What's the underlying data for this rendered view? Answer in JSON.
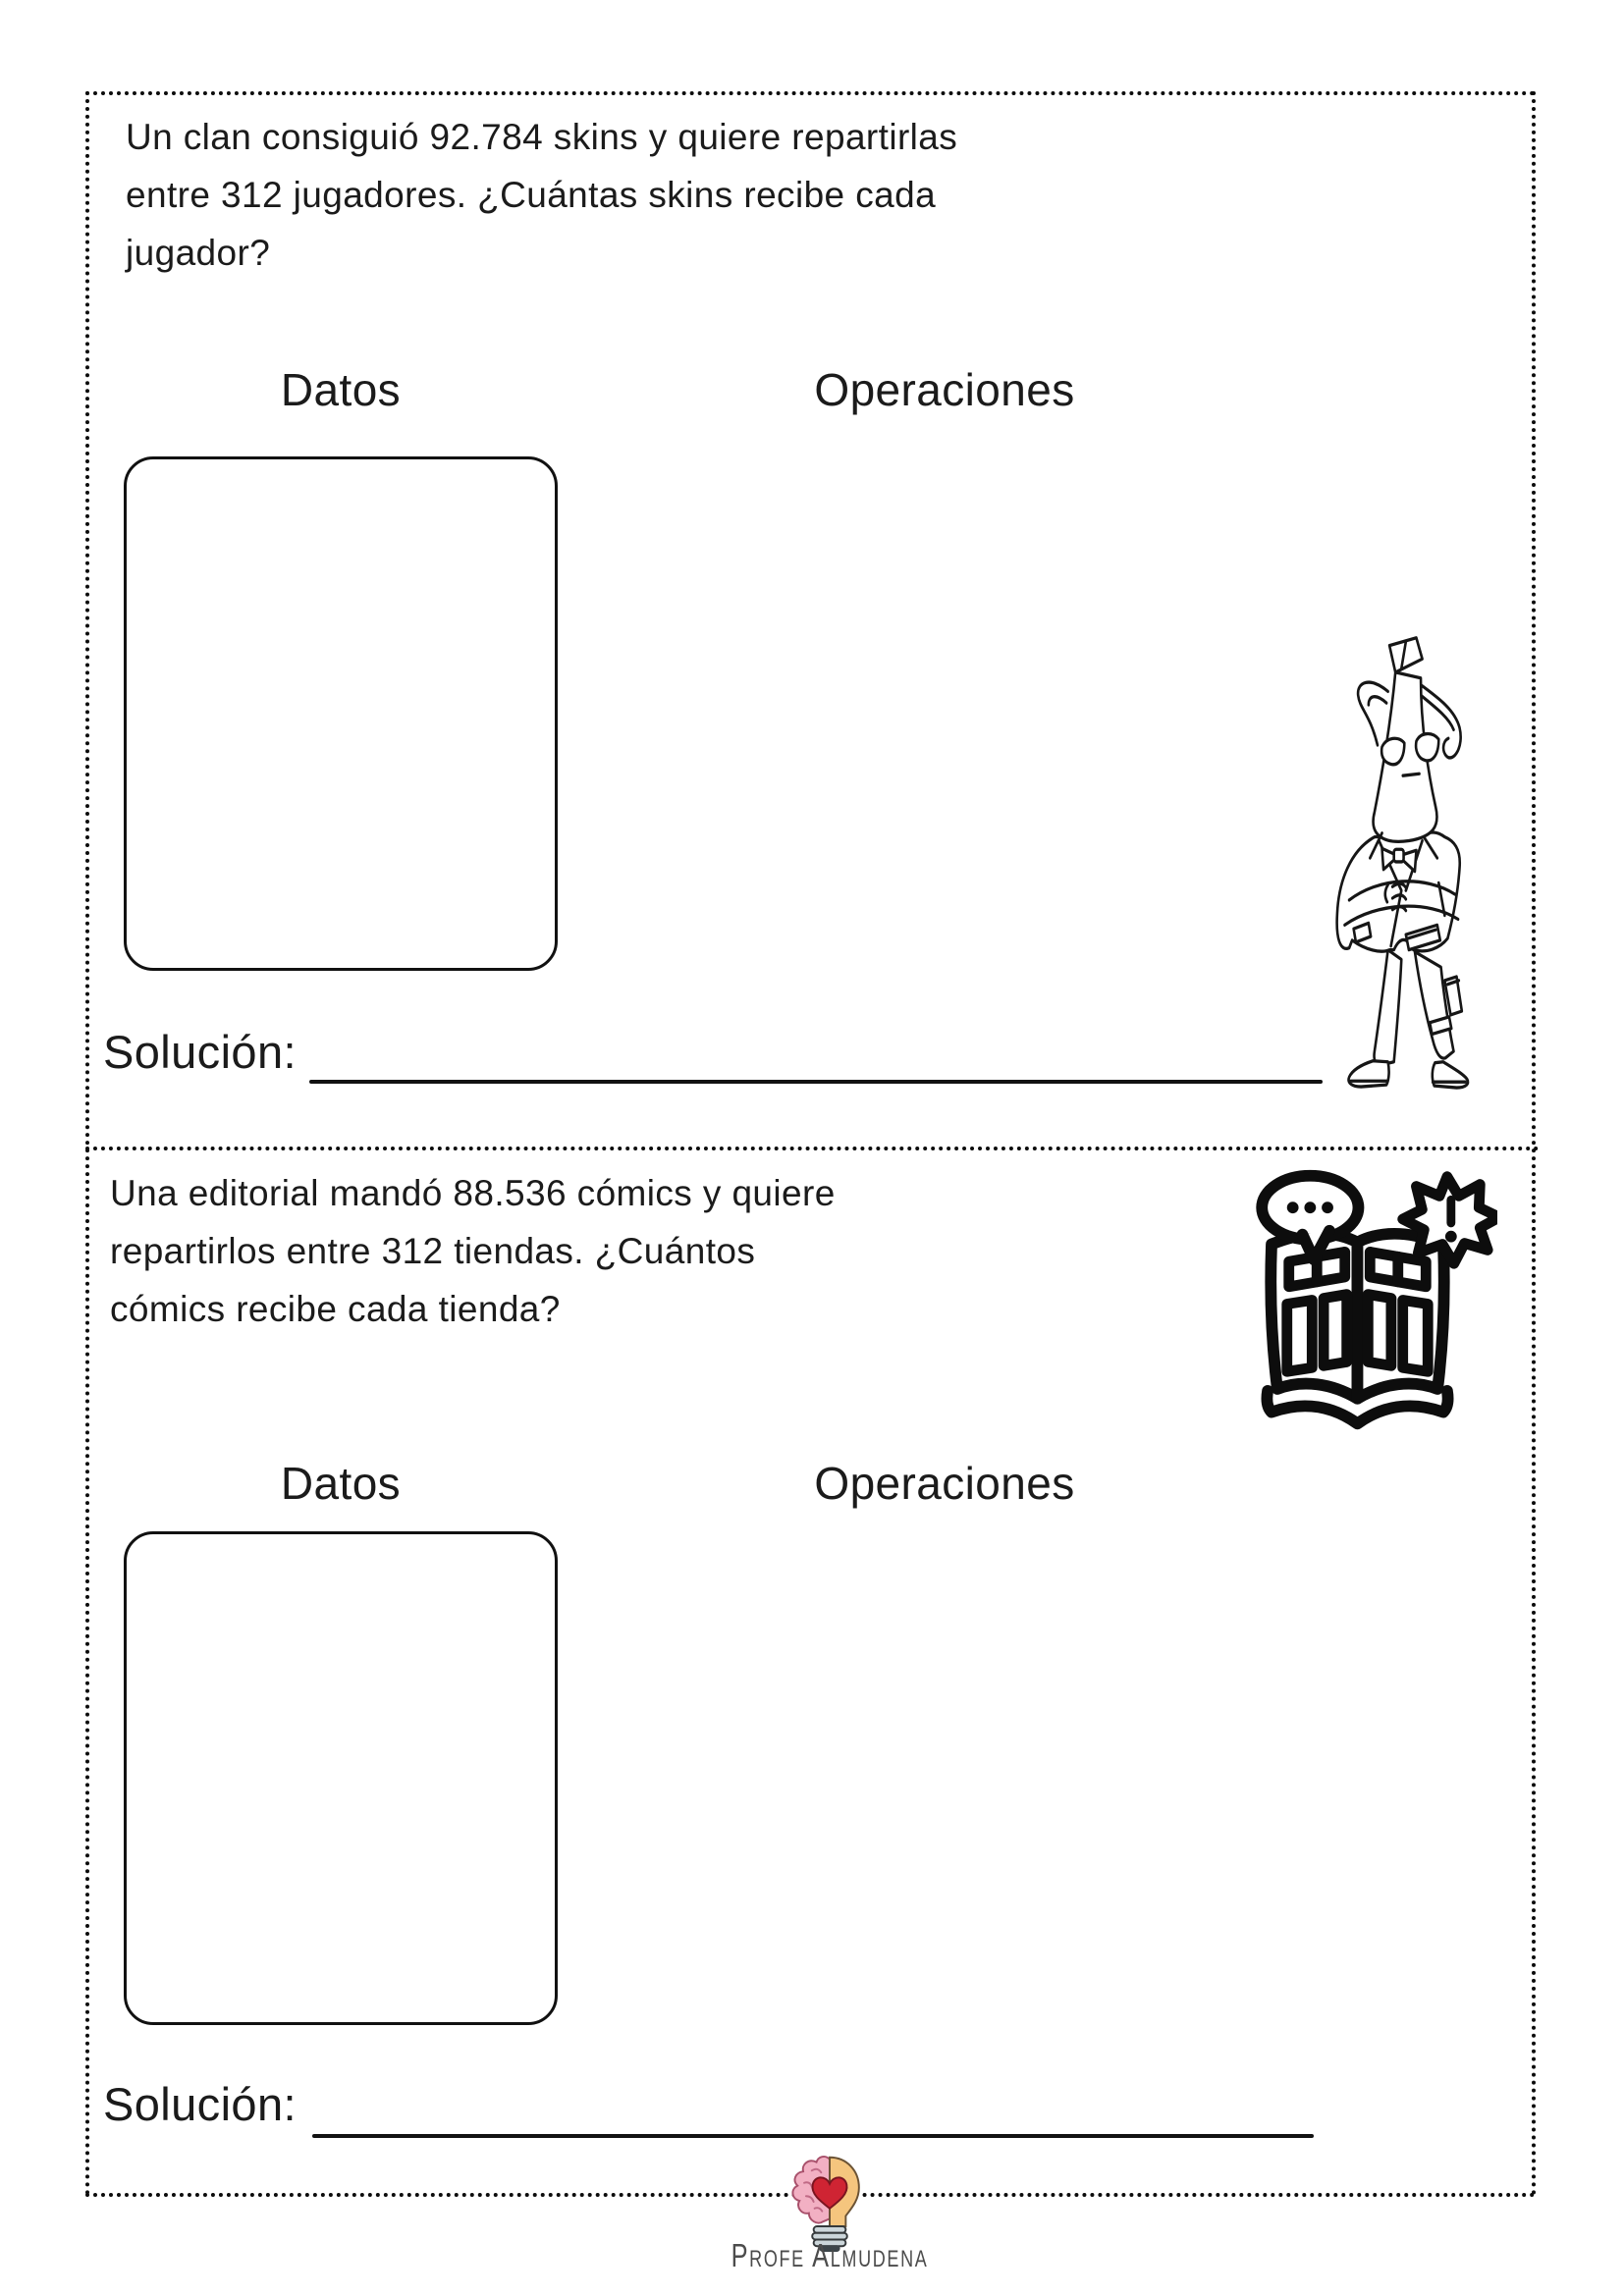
{
  "worksheet": {
    "ink_color": "#111111",
    "problem1": {
      "lines": [
        "Un clan consiguió 92.784 skins y quiere repartirlas",
        "entre 312 jugadores. ¿Cuántas skins recibe cada",
        "jugador?"
      ],
      "datos_label": "Datos",
      "operaciones_label": "Operaciones",
      "solucion_label": "Solución:",
      "icon": "banana-agent-character"
    },
    "problem2": {
      "lines": [
        "Una editorial mandó 88.536 cómics y quiere",
        "repartirlos entre 312 tiendas. ¿Cuántos",
        "cómics recibe cada tienda?"
      ],
      "datos_label": "Datos",
      "operaciones_label": "Operaciones",
      "solucion_label": "Solución:",
      "icon": "comic-book-icon"
    },
    "footer": {
      "brand": "Profe Almudena",
      "logo_icon": "brain-lightbulb-heart-logo",
      "logo_colors": {
        "brain_pink": "#f2b0c3",
        "bulb_yellow": "#f5c57e",
        "heart_red": "#cf2433",
        "base_gray": "#ccd6da",
        "tip_dark": "#3d4549"
      }
    }
  }
}
